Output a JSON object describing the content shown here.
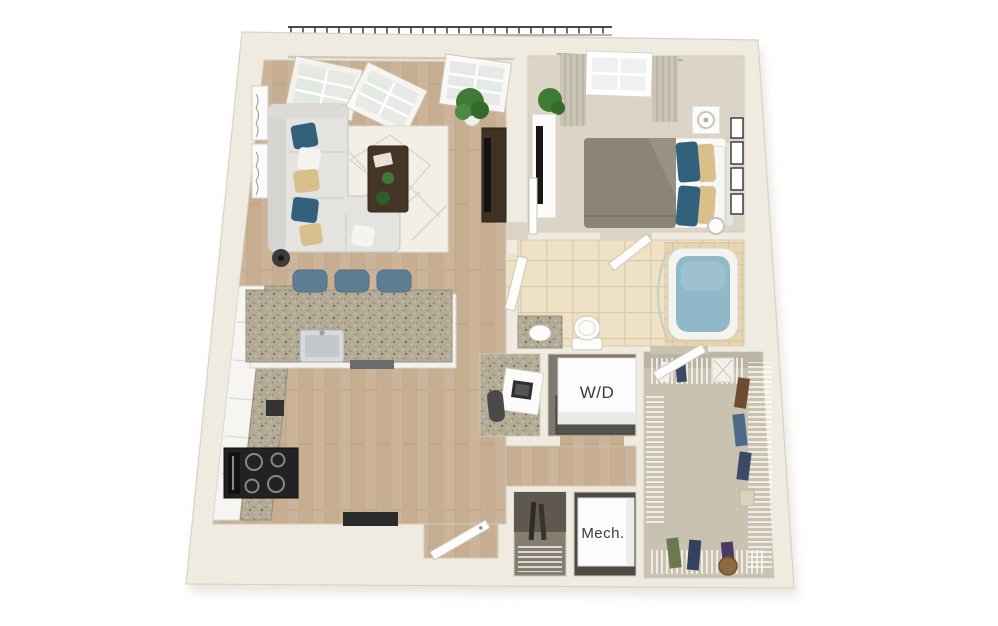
{
  "labels": {
    "washer_dryer": "W/D",
    "mechanical": "Mech."
  },
  "colors": {
    "background": "#ffffff",
    "wall": "#f0ebe1",
    "wall_edge": "#d9d2c4",
    "shadow": "#d5d0c5",
    "floor_wood": "#c7ae91",
    "wood_dark": "#a98f74",
    "carpet_bedroom": "#dcd5c7",
    "carpet_closet": "#cac2b1",
    "tile": "#eee1c6",
    "tile_line": "#dbcba6",
    "tile_tub": "#e6d5b0",
    "water": "#8fb9c9",
    "counter": "#b3ab96",
    "cabinet": "#f6f5f2",
    "stool_blue": "#5d7f95",
    "sofa": "#e4e3e0",
    "pillow_blue": "#33617c",
    "pillow_tan": "#d9c08b",
    "duvet_gray": "#8d8478",
    "dark_wood": "#453527",
    "appliance_black": "#222222",
    "door_white": "#fdfdfb",
    "label_text": "#3c3c3c",
    "plant_green": "#3f7a36",
    "railing": "#4a4a4a"
  }
}
